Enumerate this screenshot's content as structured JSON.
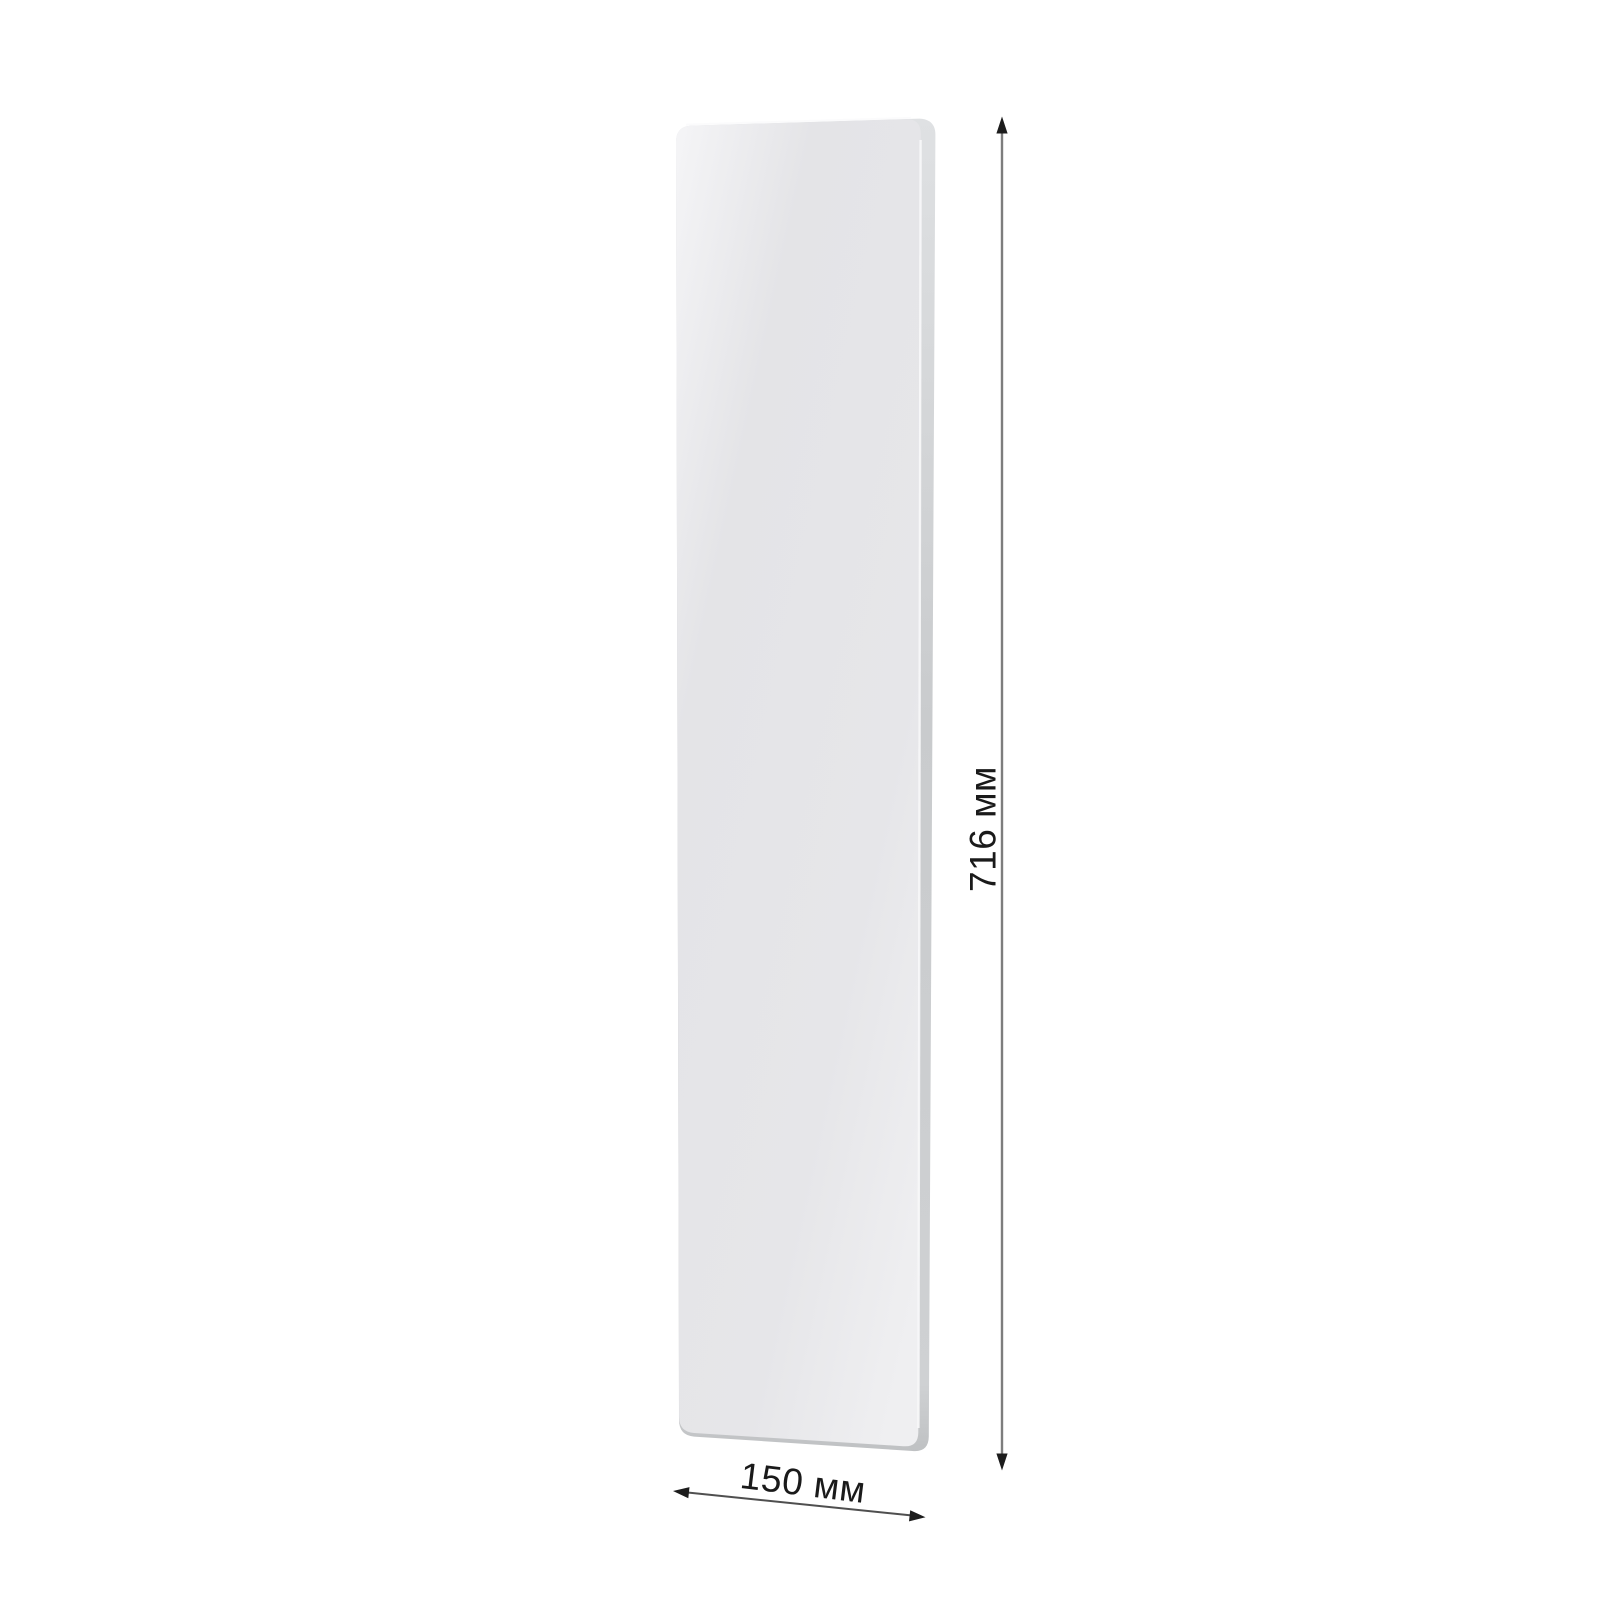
{
  "diagram": {
    "background_color": "#ffffff",
    "dimensions": {
      "height_label": "716 мм",
      "width_label": "150 мм"
    },
    "panel": {
      "face_color_light": "#f5f5f7",
      "face_color": "#e4e4e7",
      "edge_color": "#cbcdcf",
      "edge_highlight_color": "#f8f8f9"
    },
    "annotation": {
      "vertical_line_color": "#7d7d7d",
      "horizontal_line_color": "#4f4f4f",
      "arrowhead_color": "#1c1c1c",
      "text_color": "#1a1a1a"
    }
  }
}
